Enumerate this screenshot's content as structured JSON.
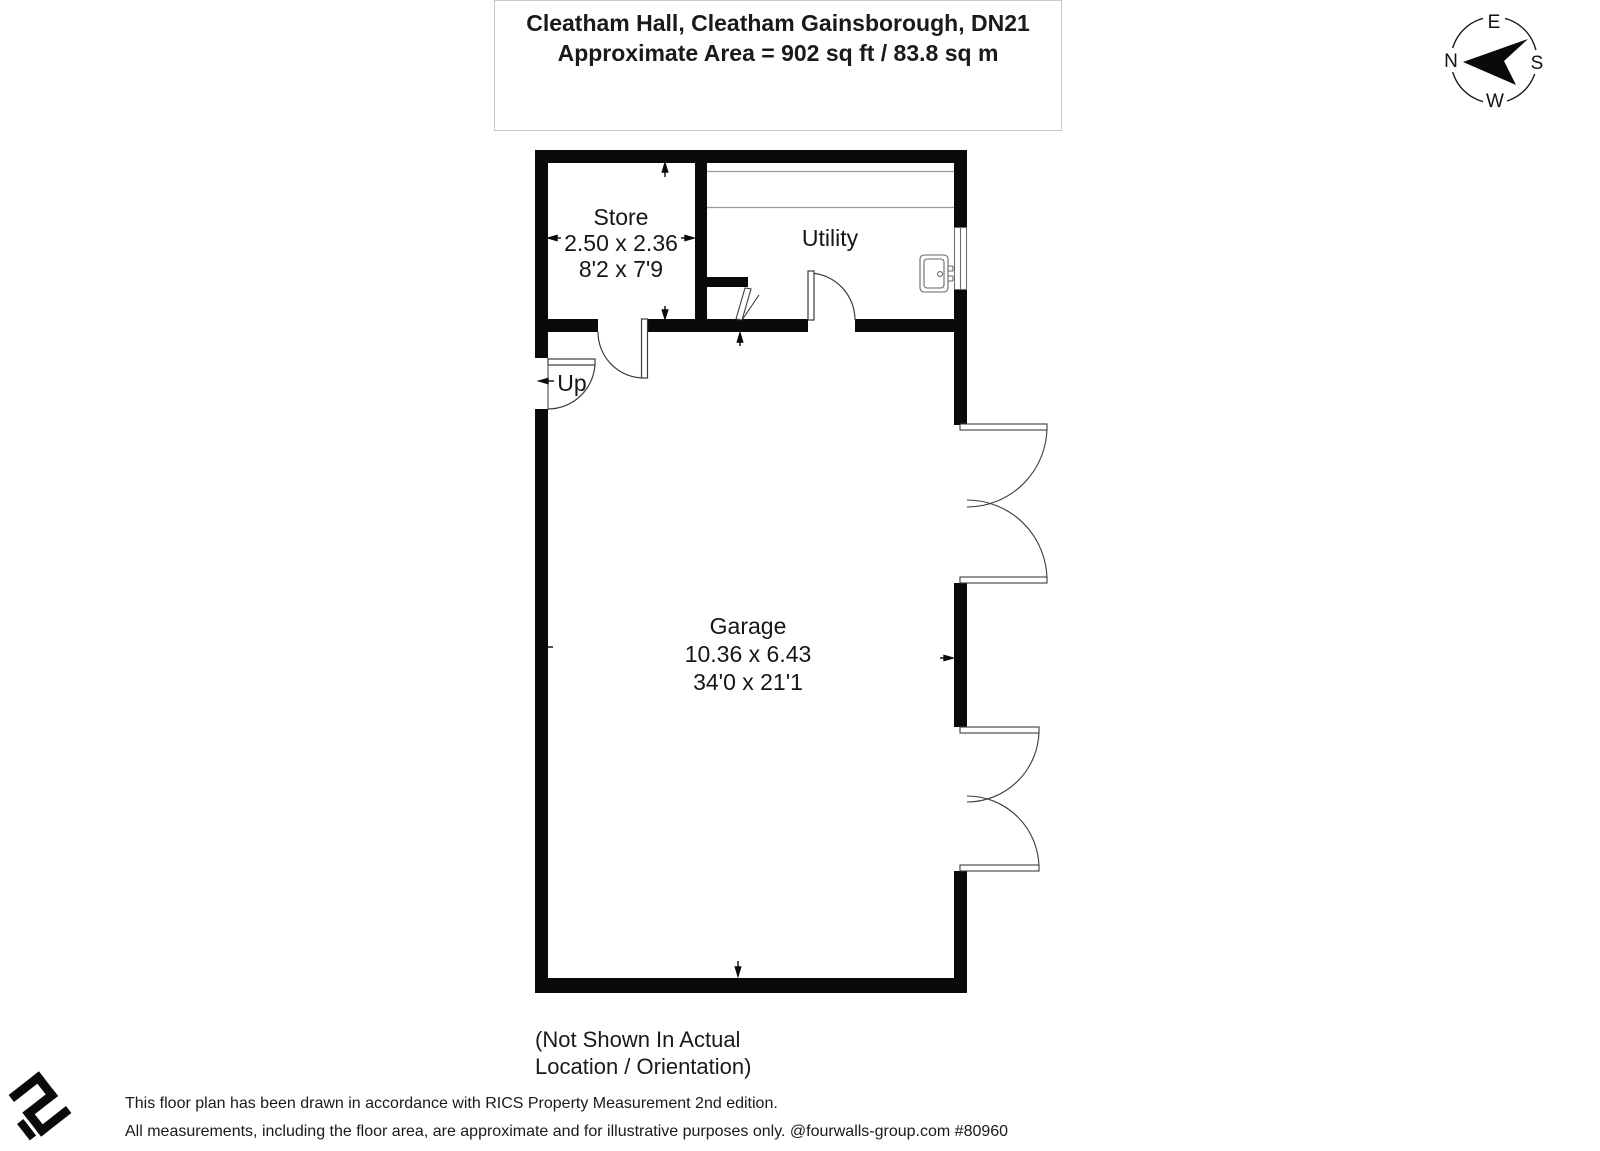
{
  "header": {
    "title": "Cleatham Hall, Cleatham Gainsborough, DN21",
    "area": "Approximate Area = 902 sq ft / 83.8 sq m"
  },
  "compass": {
    "north": "N",
    "east": "E",
    "south": "S",
    "west": "W"
  },
  "rooms": {
    "store": {
      "name": "Store",
      "metric": "2.50 x 2.36",
      "imperial": "8'2 x 7'9"
    },
    "utility": {
      "name": "Utility"
    },
    "garage": {
      "name": "Garage",
      "metric": "10.36 x 6.43",
      "imperial": "34'0 x 21'1"
    }
  },
  "stairs": {
    "label": "Up"
  },
  "caption": {
    "line1": "(Not Shown In Actual",
    "line2": "Location / Orientation)"
  },
  "footer": {
    "line1": "This floor plan has been drawn in accordance with RICS Property Measurement 2nd edition.",
    "line2": "All measurements, including the floor area, are approximate and for illustrative purposes only. @fourwalls-group.com #80960"
  },
  "colors": {
    "wall": "#0a0a0a",
    "thin_line": "#3c3c3c",
    "counter_line": "#9a9a9a",
    "fixture_line": "#666666",
    "title_border": "#c9c9c9"
  }
}
